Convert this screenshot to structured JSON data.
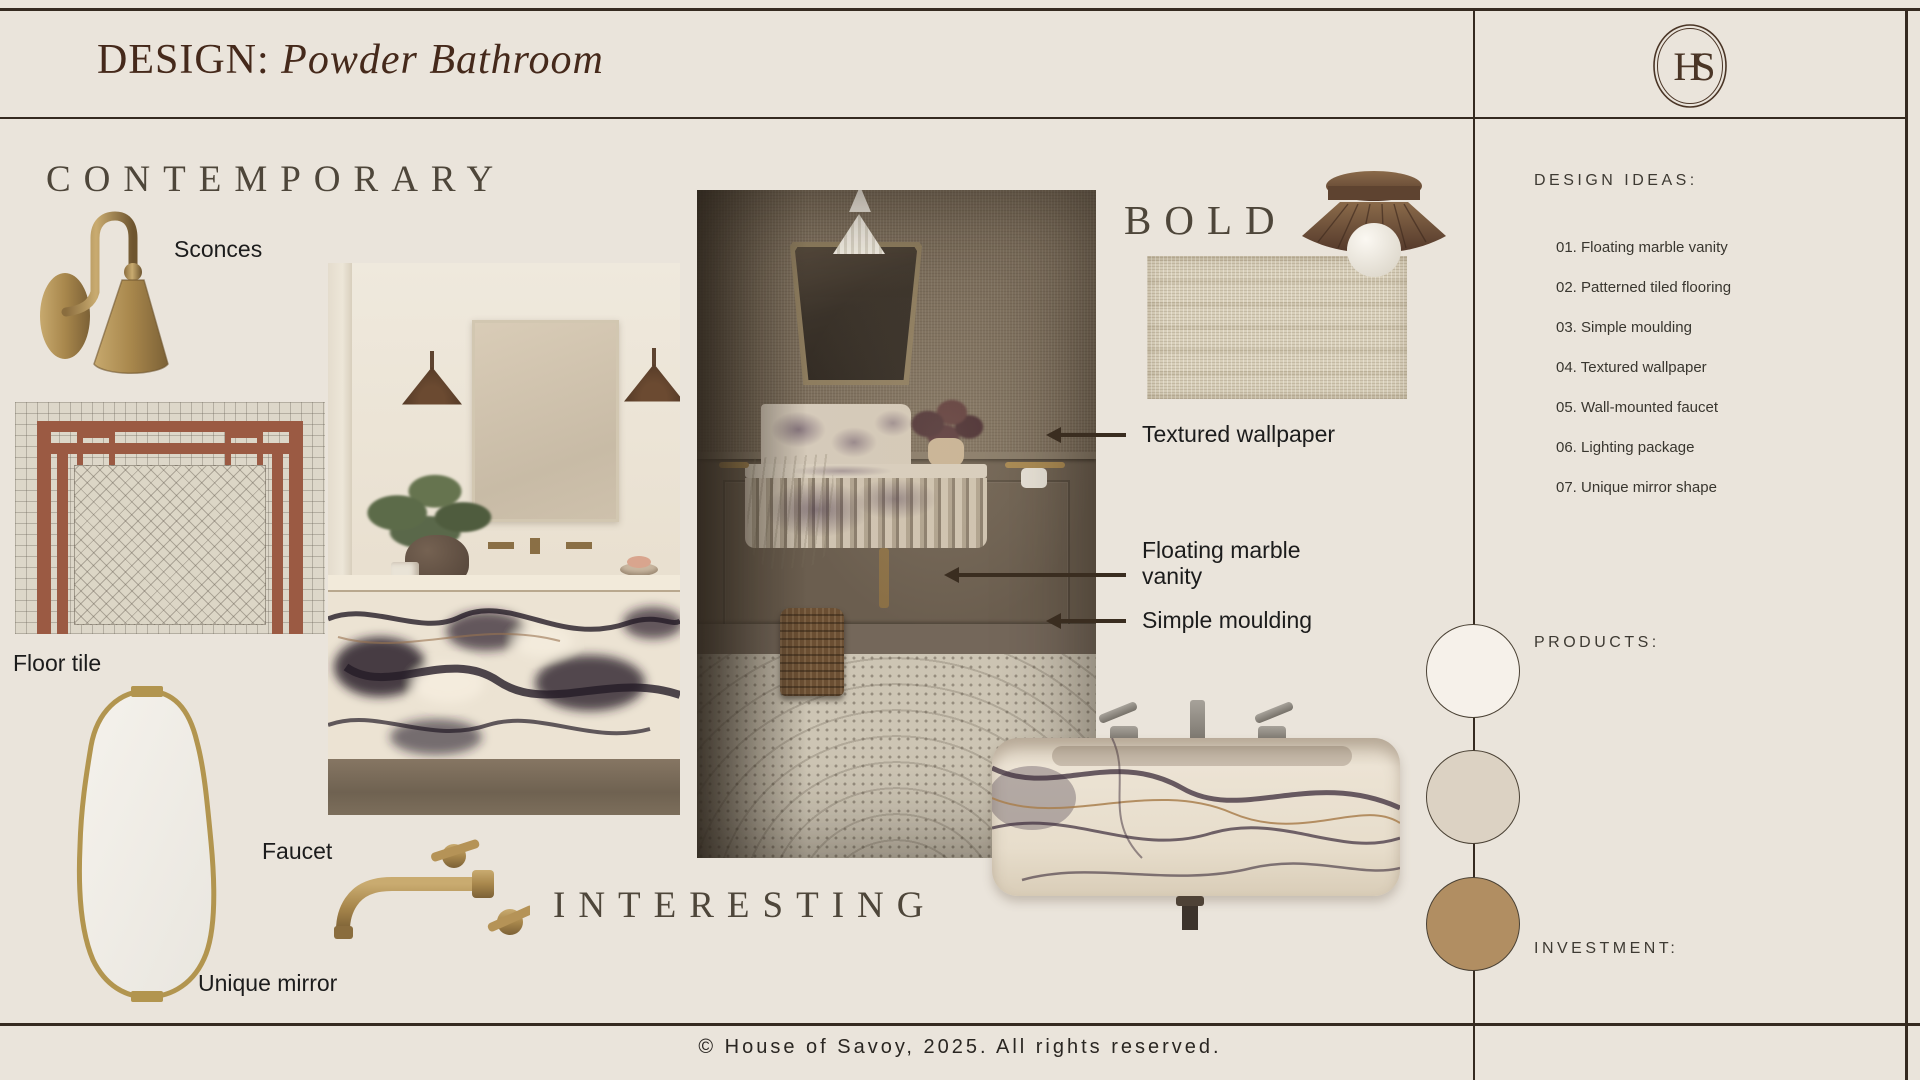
{
  "header": {
    "title_prefix": "DESIGN:",
    "title_name": "Powder Bathroom",
    "logo_monogram": "HS"
  },
  "board": {
    "heading_contemporary": "CONTEMPORARY",
    "heading_bold": "BOLD",
    "heading_interesting": "INTERESTING",
    "label_sconces": "Sconces",
    "label_floor_tile": "Floor tile",
    "label_faucet": "Faucet",
    "label_unique_mirror": "Unique mirror",
    "annotations": [
      {
        "label": "Textured wallpaper"
      },
      {
        "label": "Floating marble vanity"
      },
      {
        "label": "Simple moulding"
      }
    ]
  },
  "sidebar": {
    "design_ideas_title": "DESIGN IDEAS:",
    "design_ideas": [
      "01. Floating marble vanity",
      "02. Patterned tiled flooring",
      "03. Simple moulding",
      "04. Textured wallpaper",
      "05. Wall-mounted faucet",
      "06. Lighting package",
      "07. Unique mirror shape"
    ],
    "products_title": "PRODUCTS:",
    "investment_title": "INVESTMENT:",
    "product_swatches": [
      {
        "name": "swatch-cream",
        "color": "#F6F1EA"
      },
      {
        "name": "swatch-beige",
        "color": "#DCD2C3"
      },
      {
        "name": "swatch-camel",
        "color": "#B18E62"
      }
    ]
  },
  "footer": {
    "copyright": "© House of Savoy, 2025. All rights reserved."
  },
  "palette": {
    "background": "#EAE4DB",
    "line": "#352A20",
    "heading": "#4E463A",
    "title": "#45291B",
    "label": "#1C1C1C",
    "arrow": "#3A2D20"
  }
}
